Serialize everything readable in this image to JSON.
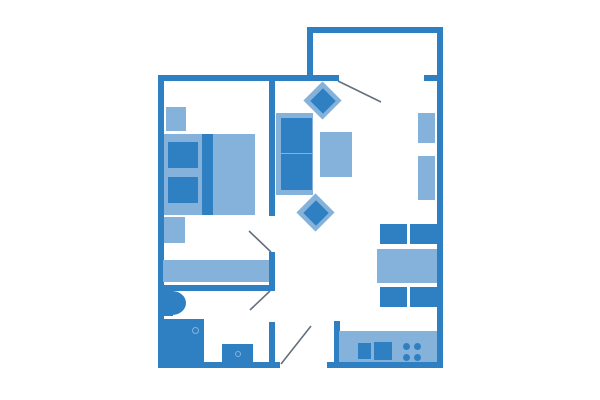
{
  "canvas": {
    "width": 600,
    "height": 400,
    "background": "#ffffff"
  },
  "palette": {
    "wall": "#2E80C2",
    "furniture_dark": "#2E80C2",
    "furniture_light": "#85B2DB",
    "door_line": "#64707C"
  },
  "floorplan": {
    "walls": [
      {
        "name": "balcony-wall-top",
        "x": 307,
        "y": 27,
        "w": 136,
        "h": 6
      },
      {
        "name": "balcony-wall-left",
        "x": 307,
        "y": 27,
        "w": 6,
        "h": 54
      },
      {
        "name": "exterior-wall-right",
        "x": 437,
        "y": 27,
        "w": 6,
        "h": 341
      },
      {
        "name": "exterior-wall-top",
        "x": 158,
        "y": 75,
        "w": 181,
        "h": 6
      },
      {
        "name": "exterior-wall-top-right-segment",
        "x": 424,
        "y": 75,
        "w": 13,
        "h": 6
      },
      {
        "name": "exterior-wall-left",
        "x": 158,
        "y": 75,
        "w": 6,
        "h": 293
      },
      {
        "name": "exterior-wall-bottom-left",
        "x": 158,
        "y": 362,
        "w": 122,
        "h": 6
      },
      {
        "name": "exterior-wall-bottom-right",
        "x": 327,
        "y": 362,
        "w": 116,
        "h": 6
      },
      {
        "name": "wall-bedroom-living-upper",
        "x": 269,
        "y": 81,
        "w": 6,
        "h": 135
      },
      {
        "name": "wall-bedroom-living-lower",
        "x": 269,
        "y": 252,
        "w": 6,
        "h": 39
      },
      {
        "name": "wall-bathroom-top",
        "x": 164,
        "y": 285,
        "w": 111,
        "h": 6
      },
      {
        "name": "wall-bathroom-right",
        "x": 269,
        "y": 322,
        "w": 6,
        "h": 40
      },
      {
        "name": "wall-kitchen-left",
        "x": 334,
        "y": 321,
        "w": 6,
        "h": 41
      }
    ],
    "furniture": [
      {
        "name": "nightstand-top",
        "shape": "rect",
        "tone": "light",
        "x": 166,
        "y": 107,
        "w": 20,
        "h": 24
      },
      {
        "name": "bed",
        "shape": "rect",
        "tone": "light",
        "x": 164,
        "y": 134,
        "w": 91,
        "h": 81
      },
      {
        "name": "bed-pillow-top",
        "shape": "rect",
        "tone": "dark",
        "x": 168,
        "y": 142,
        "w": 30,
        "h": 26
      },
      {
        "name": "bed-pillow-bottom",
        "shape": "rect",
        "tone": "dark",
        "x": 168,
        "y": 177,
        "w": 30,
        "h": 26
      },
      {
        "name": "bed-runner",
        "shape": "rect",
        "tone": "dark",
        "x": 202,
        "y": 134,
        "w": 11,
        "h": 81
      },
      {
        "name": "nightstand-bottom",
        "shape": "rect",
        "tone": "light",
        "x": 164,
        "y": 217,
        "w": 21,
        "h": 26
      },
      {
        "name": "dresser-bench",
        "shape": "rect",
        "tone": "light",
        "x": 163,
        "y": 260,
        "w": 106,
        "h": 22
      },
      {
        "name": "armchair-top-outer",
        "shape": "diamond",
        "tone": "light",
        "x": 309,
        "y": 87,
        "w": 27,
        "h": 27
      },
      {
        "name": "armchair-top-inner",
        "shape": "diamond",
        "tone": "dark",
        "x": 314,
        "y": 92,
        "w": 18,
        "h": 18
      },
      {
        "name": "sofa",
        "shape": "rect",
        "tone": "light",
        "x": 276,
        "y": 113,
        "w": 37,
        "h": 82
      },
      {
        "name": "sofa-cushion-top",
        "shape": "rect",
        "tone": "dark",
        "x": 281,
        "y": 118,
        "w": 31,
        "h": 35
      },
      {
        "name": "sofa-cushion-bottom",
        "shape": "rect",
        "tone": "dark",
        "x": 281,
        "y": 154,
        "w": 31,
        "h": 36
      },
      {
        "name": "coffee-table",
        "shape": "rect",
        "tone": "light",
        "x": 320,
        "y": 132,
        "w": 32,
        "h": 45
      },
      {
        "name": "armchair-bottom-outer",
        "shape": "diamond",
        "tone": "light",
        "x": 302,
        "y": 199,
        "w": 27,
        "h": 27
      },
      {
        "name": "armchair-bottom-inner",
        "shape": "diamond",
        "tone": "dark",
        "x": 307,
        "y": 204,
        "w": 18,
        "h": 18
      },
      {
        "name": "wall-shelf-top",
        "shape": "rect",
        "tone": "light",
        "x": 418,
        "y": 113,
        "w": 17,
        "h": 30
      },
      {
        "name": "wall-shelf-bottom",
        "shape": "rect",
        "tone": "light",
        "x": 418,
        "y": 156,
        "w": 17,
        "h": 44
      },
      {
        "name": "dining-chair-top-left",
        "shape": "rect",
        "tone": "dark",
        "x": 380,
        "y": 224,
        "w": 27,
        "h": 20
      },
      {
        "name": "dining-chair-top-right",
        "shape": "rect",
        "tone": "dark",
        "x": 410,
        "y": 224,
        "w": 27,
        "h": 20
      },
      {
        "name": "dining-table",
        "shape": "rect",
        "tone": "light",
        "x": 377,
        "y": 249,
        "w": 60,
        "h": 34
      },
      {
        "name": "dining-chair-bottom-left",
        "shape": "rect",
        "tone": "dark",
        "x": 380,
        "y": 287,
        "w": 27,
        "h": 20
      },
      {
        "name": "dining-chair-bottom-right",
        "shape": "rect",
        "tone": "dark",
        "x": 410,
        "y": 287,
        "w": 27,
        "h": 20
      },
      {
        "name": "toilet-tank",
        "shape": "rect",
        "tone": "dark",
        "x": 164,
        "y": 290,
        "w": 9,
        "h": 26
      },
      {
        "name": "toilet-bowl",
        "shape": "bowl",
        "tone": "dark",
        "x": 172,
        "y": 291,
        "w": 14,
        "h": 24
      },
      {
        "name": "shower",
        "shape": "rect",
        "tone": "dark",
        "x": 163,
        "y": 319,
        "w": 41,
        "h": 44
      },
      {
        "name": "shower-drain",
        "shape": "ring",
        "tone": "light",
        "x": 192,
        "y": 327,
        "w": 7,
        "h": 7
      },
      {
        "name": "bathroom-sink",
        "shape": "rect",
        "tone": "dark",
        "x": 222,
        "y": 344,
        "w": 31,
        "h": 19
      },
      {
        "name": "bathroom-sink-drain",
        "shape": "ring",
        "tone": "light",
        "x": 235,
        "y": 351,
        "w": 6,
        "h": 6
      },
      {
        "name": "kitchen-counter",
        "shape": "rect",
        "tone": "light",
        "x": 339,
        "y": 331,
        "w": 98,
        "h": 31
      },
      {
        "name": "kitchen-sink",
        "shape": "rect",
        "tone": "dark",
        "x": 358,
        "y": 343,
        "w": 13,
        "h": 16
      },
      {
        "name": "kitchen-stove",
        "shape": "rect",
        "tone": "dark",
        "x": 374,
        "y": 342,
        "w": 18,
        "h": 18
      },
      {
        "name": "stove-burner-1",
        "shape": "circle",
        "tone": "dark",
        "x": 403,
        "y": 343,
        "w": 7,
        "h": 7
      },
      {
        "name": "stove-burner-2",
        "shape": "circle",
        "tone": "dark",
        "x": 414,
        "y": 343,
        "w": 7,
        "h": 7
      },
      {
        "name": "stove-burner-3",
        "shape": "circle",
        "tone": "dark",
        "x": 403,
        "y": 354,
        "w": 7,
        "h": 7
      },
      {
        "name": "stove-burner-4",
        "shape": "circle",
        "tone": "dark",
        "x": 414,
        "y": 354,
        "w": 7,
        "h": 7
      }
    ],
    "doors": [
      {
        "name": "balcony-door-swing",
        "x1": 338,
        "y1": 81,
        "x2": 381,
        "y2": 102
      },
      {
        "name": "bedroom-door-swing",
        "x1": 249,
        "y1": 231,
        "x2": 271,
        "y2": 252
      },
      {
        "name": "bathroom-door-swing",
        "x1": 250,
        "y1": 310,
        "x2": 270,
        "y2": 291
      },
      {
        "name": "entry-door-swing",
        "x1": 281,
        "y1": 364,
        "x2": 311,
        "y2": 326
      }
    ]
  }
}
